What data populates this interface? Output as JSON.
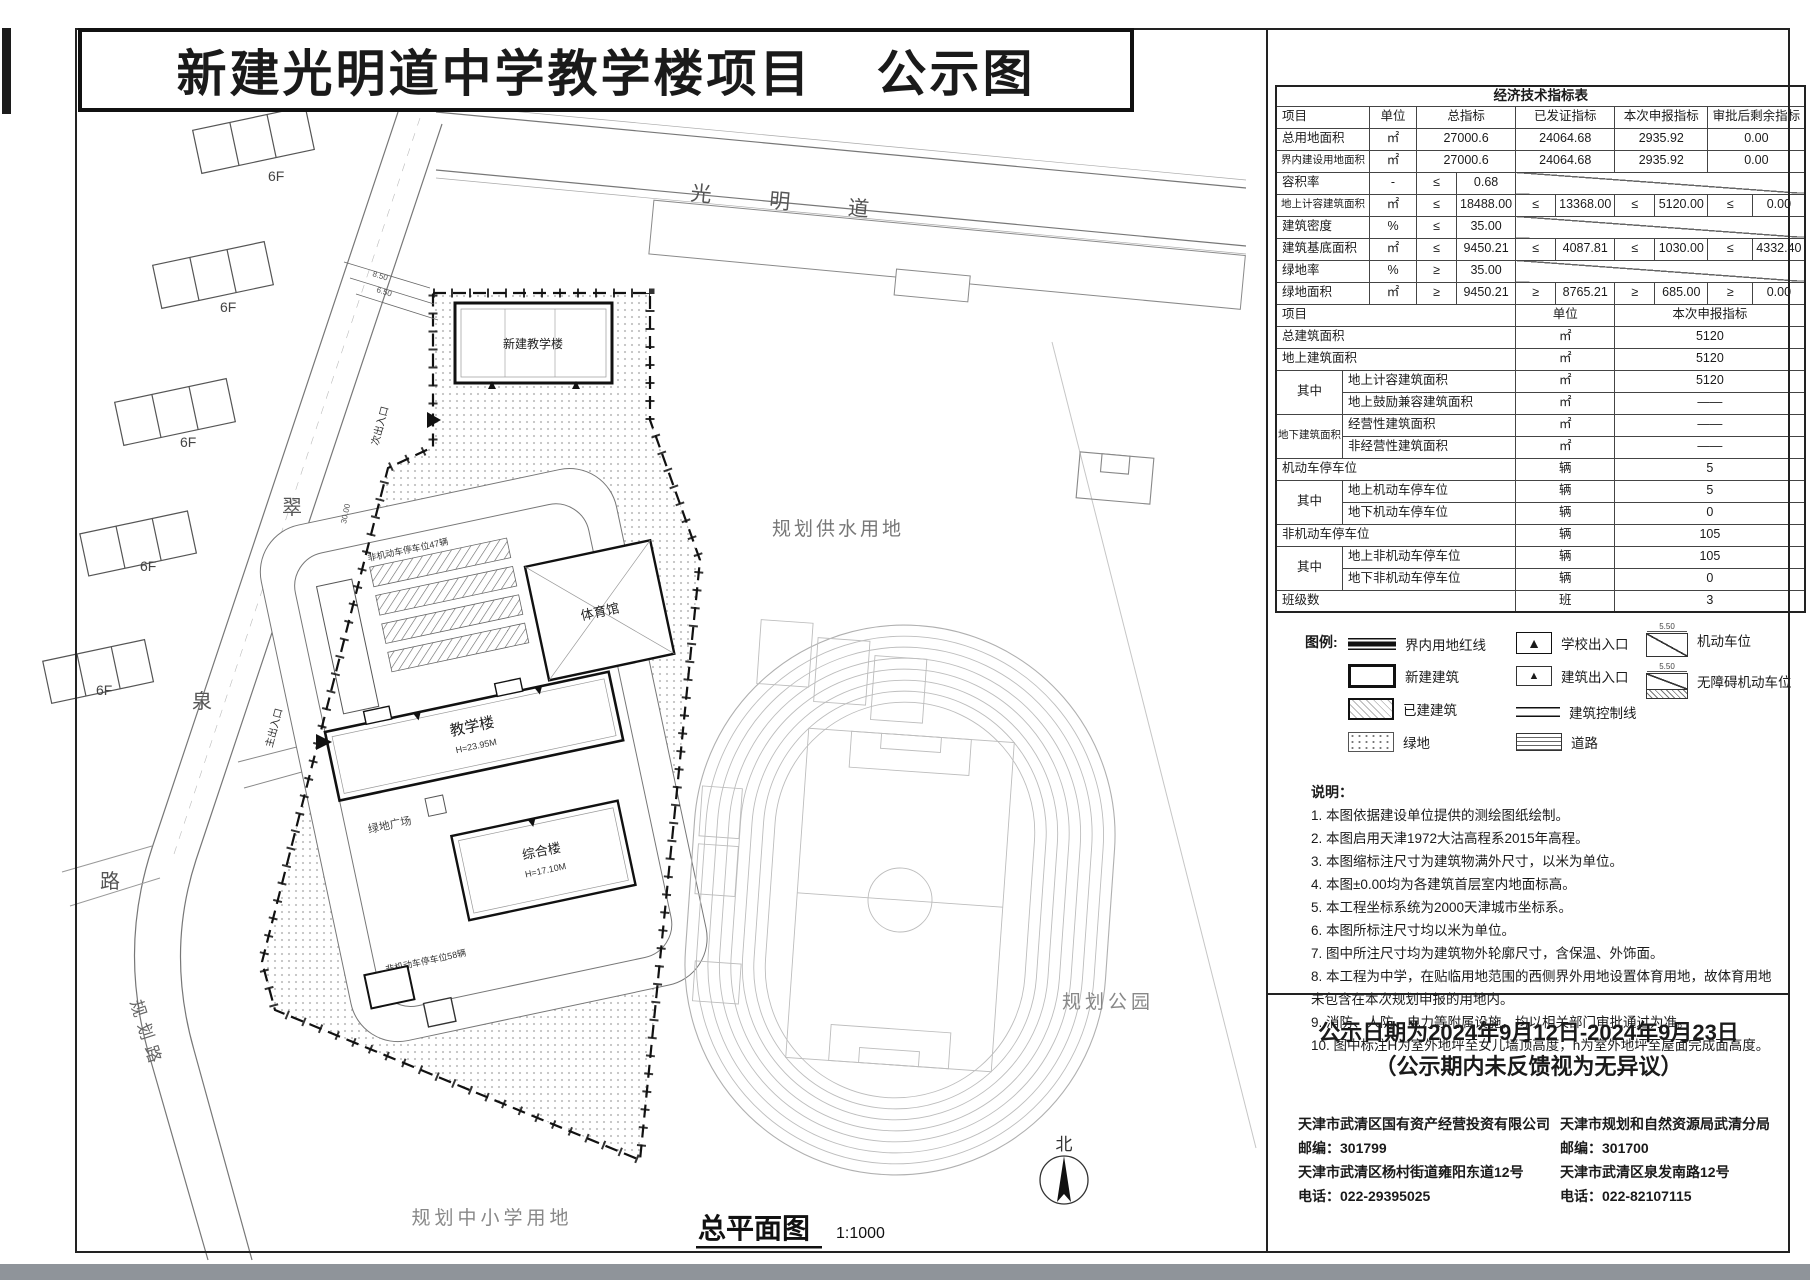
{
  "title": {
    "main": "新建光明道中学教学楼项目",
    "suffix": "公示图"
  },
  "colors": {
    "ink": "#1a1a1a",
    "faint_line": "#bdbdbd",
    "road_line": "#777777",
    "scan_band": "#8f949a"
  },
  "icons": {
    "triangle": "▲",
    "north": "北"
  },
  "econ_table": {
    "caption": "经济技术指标表",
    "col_widths": [
      65,
      27,
      47,
      40,
      52,
      40,
      53,
      40,
      53,
      45,
      52
    ],
    "rows": [
      {
        "h": 20,
        "cells": [
          {
            "t": "经济技术指标表",
            "cs": 11,
            "cls": "ttl"
          }
        ]
      },
      {
        "cells": [
          {
            "t": "项目",
            "cs": 2,
            "cls": "l"
          },
          {
            "t": "单位",
            "cls": "c"
          },
          {
            "t": "总指标",
            "cs": 2,
            "cls": "c"
          },
          {
            "t": "已发证指标",
            "cs": 2,
            "cls": "c"
          },
          {
            "t": "本次申报指标",
            "cs": 2,
            "cls": "c"
          },
          {
            "t": "审批后剩余指标",
            "cs": 2,
            "cls": "c"
          }
        ]
      },
      {
        "cells": [
          {
            "t": "总用地面积",
            "cs": 2,
            "cls": "l"
          },
          {
            "t": "㎡",
            "cls": "c"
          },
          {
            "t": "27000.6",
            "cs": 2,
            "cls": "c"
          },
          {
            "t": "24064.68",
            "cs": 2,
            "cls": "c"
          },
          {
            "t": "2935.92",
            "cs": 2,
            "cls": "c"
          },
          {
            "t": "0.00",
            "cs": 2,
            "cls": "c"
          }
        ]
      },
      {
        "cells": [
          {
            "t": "界内建设用地面积",
            "cs": 2,
            "cls": "l sm"
          },
          {
            "t": "㎡",
            "cls": "c"
          },
          {
            "t": "27000.6",
            "cs": 2,
            "cls": "c"
          },
          {
            "t": "24064.68",
            "cs": 2,
            "cls": "c"
          },
          {
            "t": "2935.92",
            "cs": 2,
            "cls": "c"
          },
          {
            "t": "0.00",
            "cs": 2,
            "cls": "c"
          }
        ]
      },
      {
        "cells": [
          {
            "t": "容积率",
            "cs": 2,
            "cls": "l"
          },
          {
            "t": "-",
            "cls": "c"
          },
          {
            "t": "≤",
            "cls": "c"
          },
          {
            "t": "0.68",
            "cls": "c"
          },
          {
            "t": "",
            "cs": 6,
            "cls": "sl"
          }
        ]
      },
      {
        "cells": [
          {
            "t": "地上计容建筑面积",
            "cs": 2,
            "cls": "l sm"
          },
          {
            "t": "㎡",
            "cls": "c"
          },
          {
            "t": "≤",
            "cls": "c"
          },
          {
            "t": "18488.00",
            "cls": "c"
          },
          {
            "t": "≤",
            "cls": "c"
          },
          {
            "t": "13368.00",
            "cls": "c"
          },
          {
            "t": "≤",
            "cls": "c"
          },
          {
            "t": "5120.00",
            "cls": "c"
          },
          {
            "t": "≤",
            "cls": "c"
          },
          {
            "t": "0.00",
            "cls": "c"
          }
        ]
      },
      {
        "cells": [
          {
            "t": "建筑密度",
            "cs": 2,
            "cls": "l"
          },
          {
            "t": "%",
            "cls": "c"
          },
          {
            "t": "≤",
            "cls": "c"
          },
          {
            "t": "35.00",
            "cls": "c"
          },
          {
            "t": "",
            "cs": 6,
            "cls": "sl"
          }
        ]
      },
      {
        "cells": [
          {
            "t": "建筑基底面积",
            "cs": 2,
            "cls": "l"
          },
          {
            "t": "㎡",
            "cls": "c"
          },
          {
            "t": "≤",
            "cls": "c"
          },
          {
            "t": "9450.21",
            "cls": "c"
          },
          {
            "t": "≤",
            "cls": "c"
          },
          {
            "t": "4087.81",
            "cls": "c"
          },
          {
            "t": "≤",
            "cls": "c"
          },
          {
            "t": "1030.00",
            "cls": "c"
          },
          {
            "t": "≤",
            "cls": "c"
          },
          {
            "t": "4332.40",
            "cls": "c"
          }
        ]
      },
      {
        "cells": [
          {
            "t": "绿地率",
            "cs": 2,
            "cls": "l"
          },
          {
            "t": "%",
            "cls": "c"
          },
          {
            "t": "≥",
            "cls": "c"
          },
          {
            "t": "35.00",
            "cls": "c"
          },
          {
            "t": "",
            "cs": 6,
            "cls": "sl"
          }
        ]
      },
      {
        "cells": [
          {
            "t": "绿地面积",
            "cs": 2,
            "cls": "l"
          },
          {
            "t": "㎡",
            "cls": "c"
          },
          {
            "t": "≥",
            "cls": "c"
          },
          {
            "t": "9450.21",
            "cls": "c"
          },
          {
            "t": "≥",
            "cls": "c"
          },
          {
            "t": "8765.21",
            "cls": "c"
          },
          {
            "t": "≥",
            "cls": "c"
          },
          {
            "t": "685.00",
            "cls": "c"
          },
          {
            "t": "≥",
            "cls": "c"
          },
          {
            "t": "0.00",
            "cls": "c"
          }
        ]
      },
      {
        "cells": [
          {
            "t": "项目",
            "cs": 5,
            "cls": "l"
          },
          {
            "t": "单位",
            "cs": 2,
            "cls": "c"
          },
          {
            "t": "本次申报指标",
            "cs": 4,
            "cls": "c"
          }
        ]
      },
      {
        "cells": [
          {
            "t": "总建筑面积",
            "cs": 5,
            "cls": "l"
          },
          {
            "t": "㎡",
            "cs": 2,
            "cls": "c"
          },
          {
            "t": "5120",
            "cs": 4,
            "cls": "c"
          }
        ]
      },
      {
        "cells": [
          {
            "t": "地上建筑面积",
            "cs": 5,
            "cls": "l"
          },
          {
            "t": "㎡",
            "cs": 2,
            "cls": "c"
          },
          {
            "t": "5120",
            "cs": 4,
            "cls": "c"
          }
        ]
      },
      {
        "cells": [
          {
            "t": "其中",
            "rs": 2,
            "cls": "c"
          },
          {
            "t": "地上计容建筑面积",
            "cs": 4,
            "cls": "l"
          },
          {
            "t": "㎡",
            "cs": 2,
            "cls": "c"
          },
          {
            "t": "5120",
            "cs": 4,
            "cls": "c"
          }
        ]
      },
      {
        "cells": [
          {
            "t": "地上鼓励兼容建筑面积",
            "cs": 4,
            "cls": "l"
          },
          {
            "t": "㎡",
            "cs": 2,
            "cls": "c"
          },
          {
            "t": "——",
            "cs": 4,
            "cls": "c"
          }
        ]
      },
      {
        "cells": [
          {
            "t": "地下建筑面积",
            "rs": 2,
            "cls": "sm"
          },
          {
            "t": "经营性建筑面积",
            "cs": 4,
            "cls": "l"
          },
          {
            "t": "㎡",
            "cs": 2,
            "cls": "c"
          },
          {
            "t": "——",
            "cs": 4,
            "cls": "c"
          }
        ]
      },
      {
        "cells": [
          {
            "t": "非经营性建筑面积",
            "cs": 4,
            "cls": "l"
          },
          {
            "t": "㎡",
            "cs": 2,
            "cls": "c"
          },
          {
            "t": "——",
            "cs": 4,
            "cls": "c"
          }
        ]
      },
      {
        "cells": [
          {
            "t": "机动车停车位",
            "cs": 5,
            "cls": "l"
          },
          {
            "t": "辆",
            "cs": 2,
            "cls": "c"
          },
          {
            "t": "5",
            "cs": 4,
            "cls": "c"
          }
        ]
      },
      {
        "cells": [
          {
            "t": "其中",
            "rs": 2,
            "cls": "c"
          },
          {
            "t": "地上机动车停车位",
            "cs": 4,
            "cls": "l"
          },
          {
            "t": "辆",
            "cs": 2,
            "cls": "c"
          },
          {
            "t": "5",
            "cs": 4,
            "cls": "c"
          }
        ]
      },
      {
        "cells": [
          {
            "t": "地下机动车停车位",
            "cs": 4,
            "cls": "l"
          },
          {
            "t": "辆",
            "cs": 2,
            "cls": "c"
          },
          {
            "t": "0",
            "cs": 4,
            "cls": "c"
          }
        ]
      },
      {
        "cells": [
          {
            "t": "非机动车停车位",
            "cs": 5,
            "cls": "l"
          },
          {
            "t": "辆",
            "cs": 2,
            "cls": "c"
          },
          {
            "t": "105",
            "cs": 4,
            "cls": "c"
          }
        ]
      },
      {
        "cells": [
          {
            "t": "其中",
            "rs": 2,
            "cls": "c"
          },
          {
            "t": "地上非机动车停车位",
            "cs": 4,
            "cls": "l"
          },
          {
            "t": "辆",
            "cs": 2,
            "cls": "c"
          },
          {
            "t": "105",
            "cs": 4,
            "cls": "c"
          }
        ]
      },
      {
        "cells": [
          {
            "t": "地下非机动车停车位",
            "cs": 4,
            "cls": "l"
          },
          {
            "t": "辆",
            "cs": 2,
            "cls": "c"
          },
          {
            "t": "0",
            "cs": 4,
            "cls": "c"
          }
        ]
      },
      {
        "cells": [
          {
            "t": "班级数",
            "cs": 5,
            "cls": "l"
          },
          {
            "t": "班",
            "cs": 2,
            "cls": "c"
          },
          {
            "t": "3",
            "cs": 4,
            "cls": "c"
          }
        ]
      }
    ]
  },
  "legend": {
    "title": "图例:",
    "items": [
      {
        "label": "界内用地红线"
      },
      {
        "label": "新建建筑"
      },
      {
        "label": "已建建筑"
      },
      {
        "label": "绿地"
      },
      {
        "label": "学校出入口"
      },
      {
        "label": "建筑出入口"
      },
      {
        "label": "建筑控制线"
      },
      {
        "label": "道路"
      },
      {
        "label": "机动车位",
        "dim": "5.50"
      },
      {
        "label": "无障碍机动车位",
        "dim": "5.50"
      }
    ]
  },
  "notes": {
    "title": "说明：",
    "lines": [
      "1. 本图依据建设单位提供的测绘图纸绘制。",
      "2. 本图启用天津1972大沽高程系2015年高程。",
      "3. 本图缩标注尺寸为建筑物满外尺寸，以米为单位。",
      "4. 本图±0.00均为各建筑首层室内地面标高。",
      "5. 本工程坐标系统为2000天津城市坐标系。",
      "6. 本图所标注尺寸均以米为单位。",
      "7. 图中所注尺寸均为建筑物外轮廓尺寸，含保温、外饰面。",
      "8. 本工程为中学，在贴临用地范围的西侧界外用地设置体育用地，故体育用地未包含在本次规划申报的用地内。",
      "9. 消防、人防、电力等附属设施，均以相关部门审批通过为准。",
      "10. 图中标注H为室外地坪至女儿墙顶高度，h为室外地坪至屋面完成面高度。"
    ]
  },
  "notice": {
    "line1": "公示日期为2024年9月12日-2024年9月23日",
    "line2": "（公示期内未反馈视为无异议）"
  },
  "contacts": [
    {
      "name": "天津市武清区国有资产经营投资有限公司",
      "postal": "邮编：301799",
      "address": "天津市武清区杨村街道雍阳东道12号",
      "phone": "电话：022-29395025"
    },
    {
      "name": "天津市规划和自然资源局武清分局",
      "postal": "邮编：301700",
      "address": "天津市武清区泉发南路12号",
      "phone": "电话：022-82107115"
    }
  ],
  "plan": {
    "roads": {
      "guangmingdao": "光明道",
      "cui": "翠",
      "quan": "泉",
      "lu": "路",
      "guihualu": "规划路"
    },
    "areas": {
      "water": "规划供水用地",
      "park": "规划公园",
      "school_land": "规划中小学用地"
    },
    "floor_label": "6F",
    "buildings": {
      "new_teaching": "新建教学楼",
      "teaching": "教学楼",
      "teaching_h": "H=23.95M",
      "complex": "综合楼",
      "complex_h": "H=17.10M",
      "gym": "体育馆",
      "plaza": "绿地广场"
    },
    "parking_note_1": "非机动车停车位47辆",
    "parking_note_2": "非机动车停车位58辆",
    "entrance_main": "主出入口",
    "entrance_secondary": "次出入口",
    "dims": [
      "8.50",
      "6.50",
      "30.00"
    ],
    "caption": "总平面图",
    "scale": "1:1000",
    "north": "北"
  }
}
